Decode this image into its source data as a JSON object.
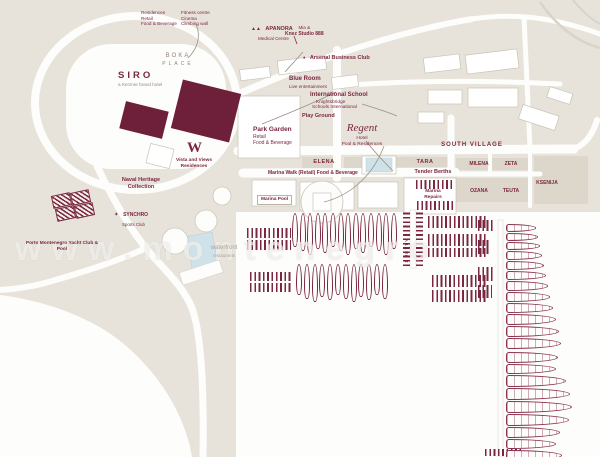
{
  "colors": {
    "land": "#e7e3da",
    "block": "#dcd7ca",
    "building_maroon": "#6e1f3a",
    "accent_maroon": "#7b2741",
    "water": "#fdfdfb",
    "pool_blue": "#cfe2ea",
    "muted_text": "#98887e"
  },
  "legend": {
    "col1": [
      "Residences",
      "Retail",
      "Food & Beverage"
    ],
    "col2": [
      "Fitness centre",
      "Cinema",
      "Climbing wall"
    ]
  },
  "places": {
    "boka1": "BOKA",
    "boka2": "PLACE",
    "siro": "SIRO",
    "siro_sub": "a Kerzner brand hotel",
    "medical": "APANORA",
    "medical_sub": "Medical Centre",
    "studio1": "Mia &",
    "studio2": "Knez Studio 888",
    "business": "Arsenal Business Club",
    "blue1": "Blue Room",
    "blue2": "Live entertainment",
    "school1": "International School",
    "school2": "Knightsbridge",
    "school3": "Schools International",
    "playground": "Play Ground",
    "park1": "Park Garden",
    "park2": "Retail",
    "park3": "Food & Beverage",
    "regent": "Regent",
    "regent1": "Hotel",
    "regent2": "Pool & Residences",
    "vista_m": "W",
    "vista1": "Vista and Views",
    "vista2": "Residences",
    "promenade": "Marina Walk (Retail) Food & Beverage",
    "pool": "Marina Pool",
    "tender": "Tender Berths",
    "rep1": "Marina",
    "rep2": "Repairs",
    "jetty": "1 JETTY",
    "naval1": "Naval Heritage",
    "naval2": "Collection",
    "syn_icon": "✦",
    "med_icon": "▲▲",
    "biz_icon": "♦",
    "syn1": "SYNCHRO",
    "syn2": "Sports Club",
    "pmyc1": "Porto Montenegro Yacht Club &",
    "pmyc2": "Pool",
    "wf1": "waterfront",
    "wf2": "restaurants"
  },
  "streets": {
    "south_village": "SOUTH VILLAGE",
    "elena": "ELENA",
    "tara": "TARA",
    "milena": "MILENA",
    "zeta": "ZETA",
    "ozana": "OZANA",
    "teuta": "TEUTA",
    "ksenija": "KSENIJA"
  },
  "watermark": "www.montenegro",
  "marina": {
    "oval_rows": [
      {
        "x": 292,
        "y": 213,
        "count": 14,
        "w": 6,
        "h": 42,
        "gap": 7.6
      },
      {
        "x": 296,
        "y": 264,
        "count": 12,
        "w": 6,
        "h": 38,
        "gap": 7.8
      }
    ],
    "yacht_columns": [
      {
        "x": 506,
        "y": 224,
        "gap": 1,
        "boats": [
          [
            30,
            8
          ],
          [
            32,
            8
          ],
          [
            34,
            8
          ],
          [
            36,
            9
          ],
          [
            38,
            9
          ],
          [
            40,
            9
          ],
          [
            42,
            10
          ],
          [
            44,
            10
          ],
          [
            47,
            10
          ],
          [
            50,
            11
          ],
          [
            53,
            11
          ],
          [
            55,
            11
          ]
        ]
      },
      {
        "x": 506,
        "y": 352,
        "gap": 1,
        "boats": [
          [
            52,
            11
          ],
          [
            50,
            10
          ],
          [
            60,
            12
          ],
          [
            64,
            12
          ],
          [
            66,
            12
          ],
          [
            63,
            12
          ],
          [
            54,
            11
          ],
          [
            50,
            10
          ],
          [
            56,
            11
          ]
        ]
      }
    ]
  }
}
